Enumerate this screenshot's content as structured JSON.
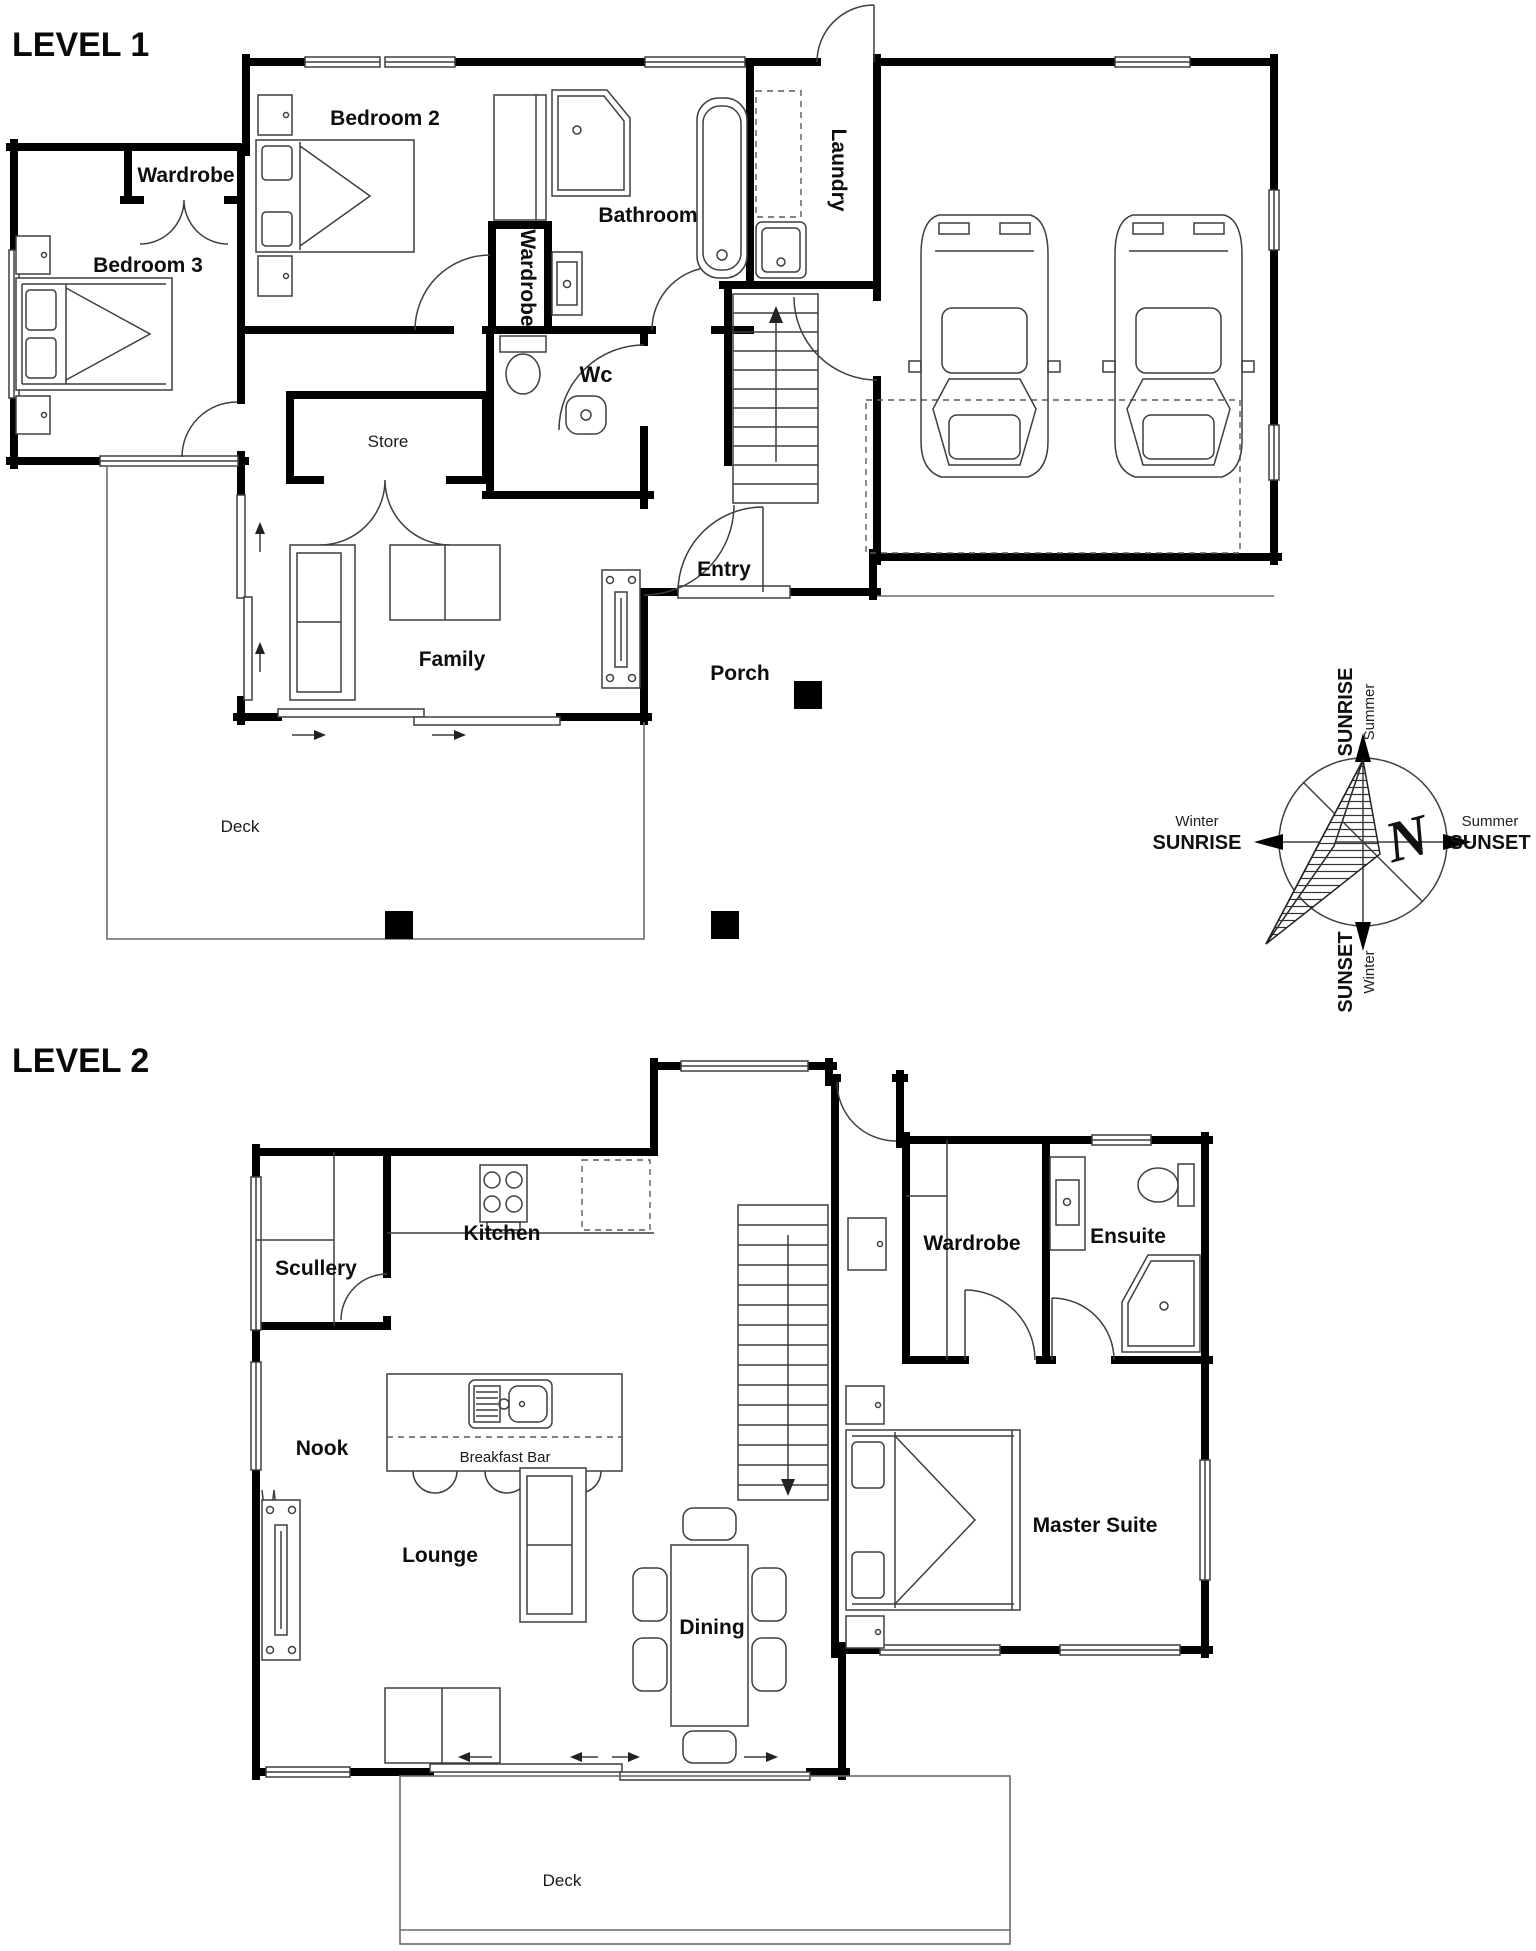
{
  "titles": {
    "level1": "LEVEL 1",
    "level2": "LEVEL 2"
  },
  "level1": {
    "rooms": {
      "bedroom2": "Bedroom 2",
      "wardrobe_bed3": "Wardrobe",
      "bedroom3": "Bedroom 3",
      "bathroom": "Bathroom",
      "laundry": "Laundry",
      "wardrobe_hall": "Wardrobe",
      "wc": "Wc",
      "store": "Store",
      "family": "Family",
      "entry": "Entry",
      "porch": "Porch",
      "deck": "Deck"
    }
  },
  "level2": {
    "rooms": {
      "scullery": "Scullery",
      "kitchen": "Kitchen",
      "nook": "Nook",
      "breakfast_bar": "Breakfast Bar",
      "wardrobe": "Wardrobe",
      "ensuite": "Ensuite",
      "master_suite": "Master Suite",
      "lounge": "Lounge",
      "dining": "Dining",
      "deck": "Deck"
    }
  },
  "compass": {
    "north": "N",
    "top_small": "Summer",
    "top_big": "SUNRISE",
    "left_small": "Winter",
    "left_big": "SUNRISE",
    "right_small": "Summer",
    "right_big": "SUNSET",
    "bottom_small": "Winter",
    "bottom_big": "SUNSET"
  },
  "colors": {
    "wall": "#000000",
    "line": "#3f3f3f",
    "background": "#ffffff"
  }
}
